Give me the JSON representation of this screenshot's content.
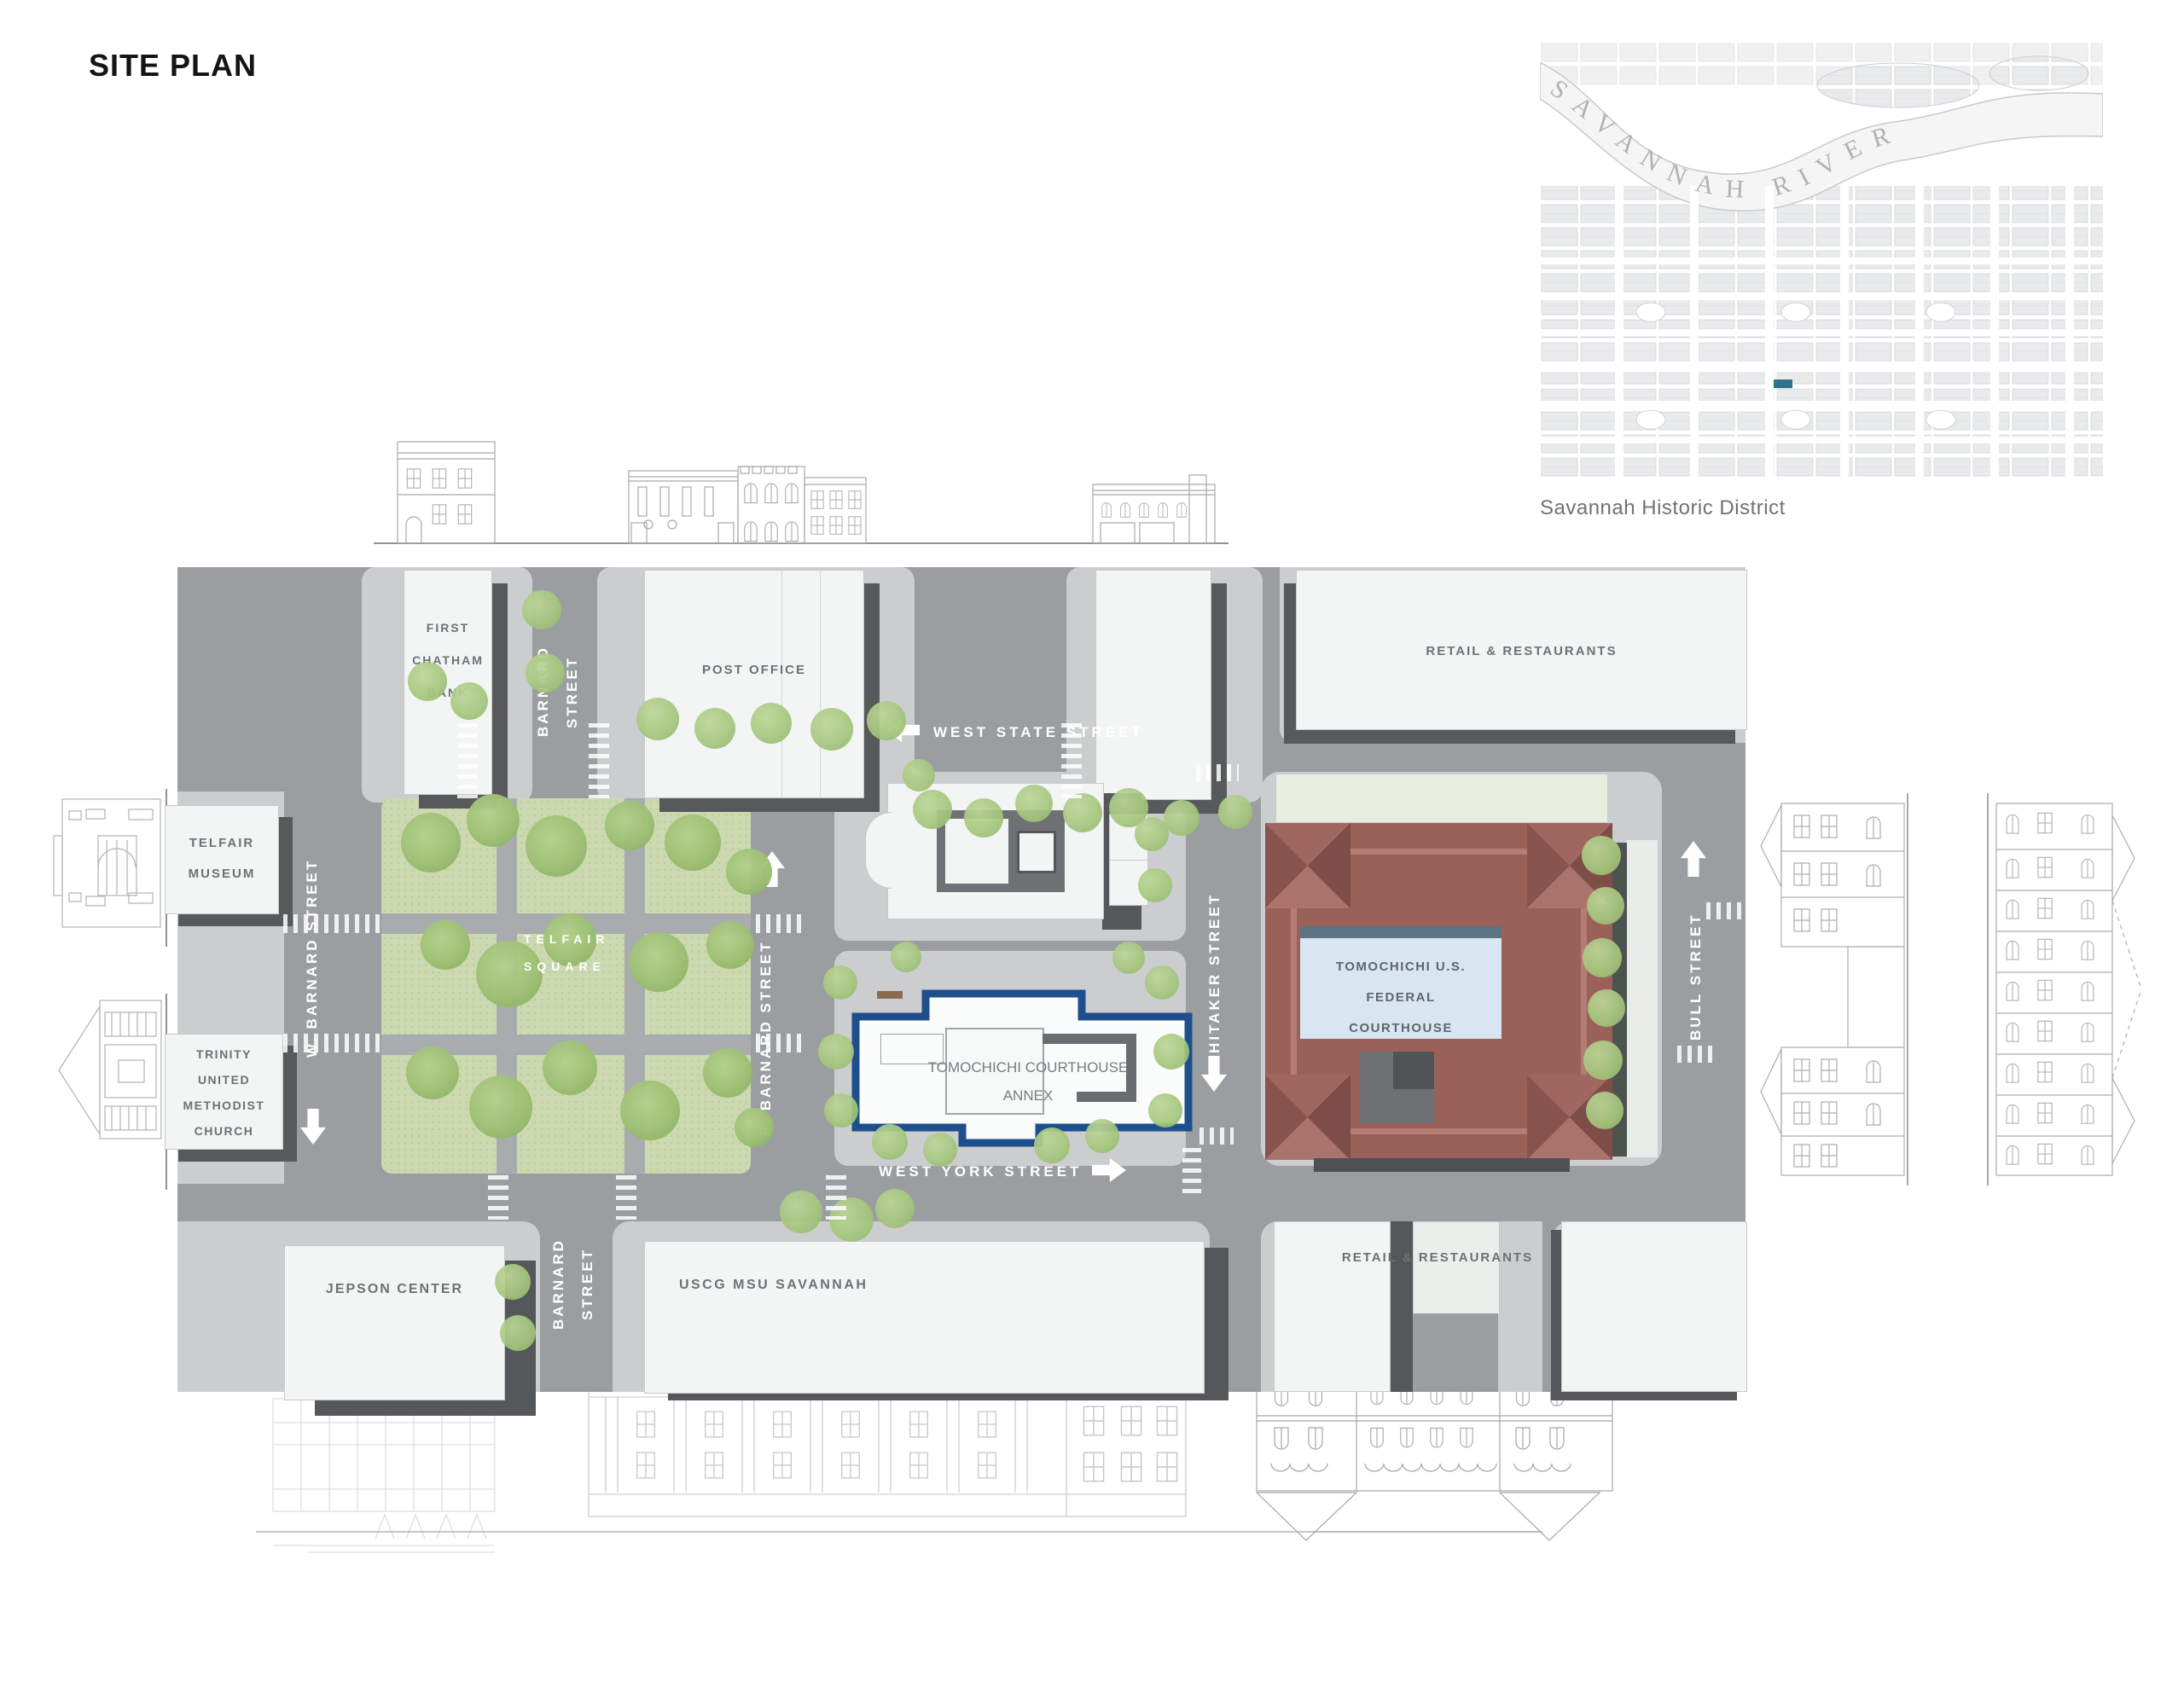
{
  "title": "SITE PLAN",
  "inset": {
    "river_label": "SAVANNAH RIVER",
    "caption": "Savannah Historic District",
    "marker_color": "#19617f"
  },
  "streets": {
    "west_state": "WEST STATE STREET",
    "west_york": "WEST YORK STREET",
    "barnard_north_a": "BARNARD",
    "barnard_north_b": "STREET",
    "barnard_south_a": "BARNARD",
    "barnard_south_b": "STREET",
    "w_barnard": "W. BARNARD STREET",
    "e_barnard": "E. BARNARD STREET",
    "whitaker": "WHITAKER STREET",
    "bull": "BULL STREET"
  },
  "buildings": {
    "first_chatham_bank": {
      "line1": "FIRST",
      "line2": "CHATHAM",
      "line3": "BANK"
    },
    "post_office": {
      "label": "POST OFFICE"
    },
    "retail_ne": {
      "label": "RETAIL & RESTAURANTS"
    },
    "telfair_museum": {
      "line1": "TELFAIR",
      "line2": "MUSEUM"
    },
    "trinity_church": {
      "line1": "TRINITY",
      "line2": "UNITED",
      "line3": "METHODIST",
      "line4": "CHURCH"
    },
    "telfair_square": {
      "line1": "TELFAIR",
      "line2": "SQUARE"
    },
    "federal_courthouse": {
      "line1": "TOMOCHICHI U.S. FEDERAL",
      "line2": "COURTHOUSE"
    },
    "courthouse_annex": {
      "line1": "TOMOCHICHI COURTHOUSE",
      "line2": "ANNEX"
    },
    "jepson_center": {
      "label": "JEPSON CENTER"
    },
    "uscg": {
      "label": "USCG MSU SAVANNAH"
    },
    "retail_se": {
      "label": "RETAIL & RESTAURANTS"
    }
  },
  "colors": {
    "street": "#9b9ea0",
    "sidewalk": "#cbcdce",
    "building": "#f3f4f4",
    "shadow": "#57595b",
    "park_green": "#ccd8af",
    "tree_green": "#a6c77e",
    "courthouse_red": "#9a6159",
    "courtyard_blue": "#d8e6f1",
    "annex_outline": "#1d4f8c",
    "label_gray": "#6e7174"
  }
}
